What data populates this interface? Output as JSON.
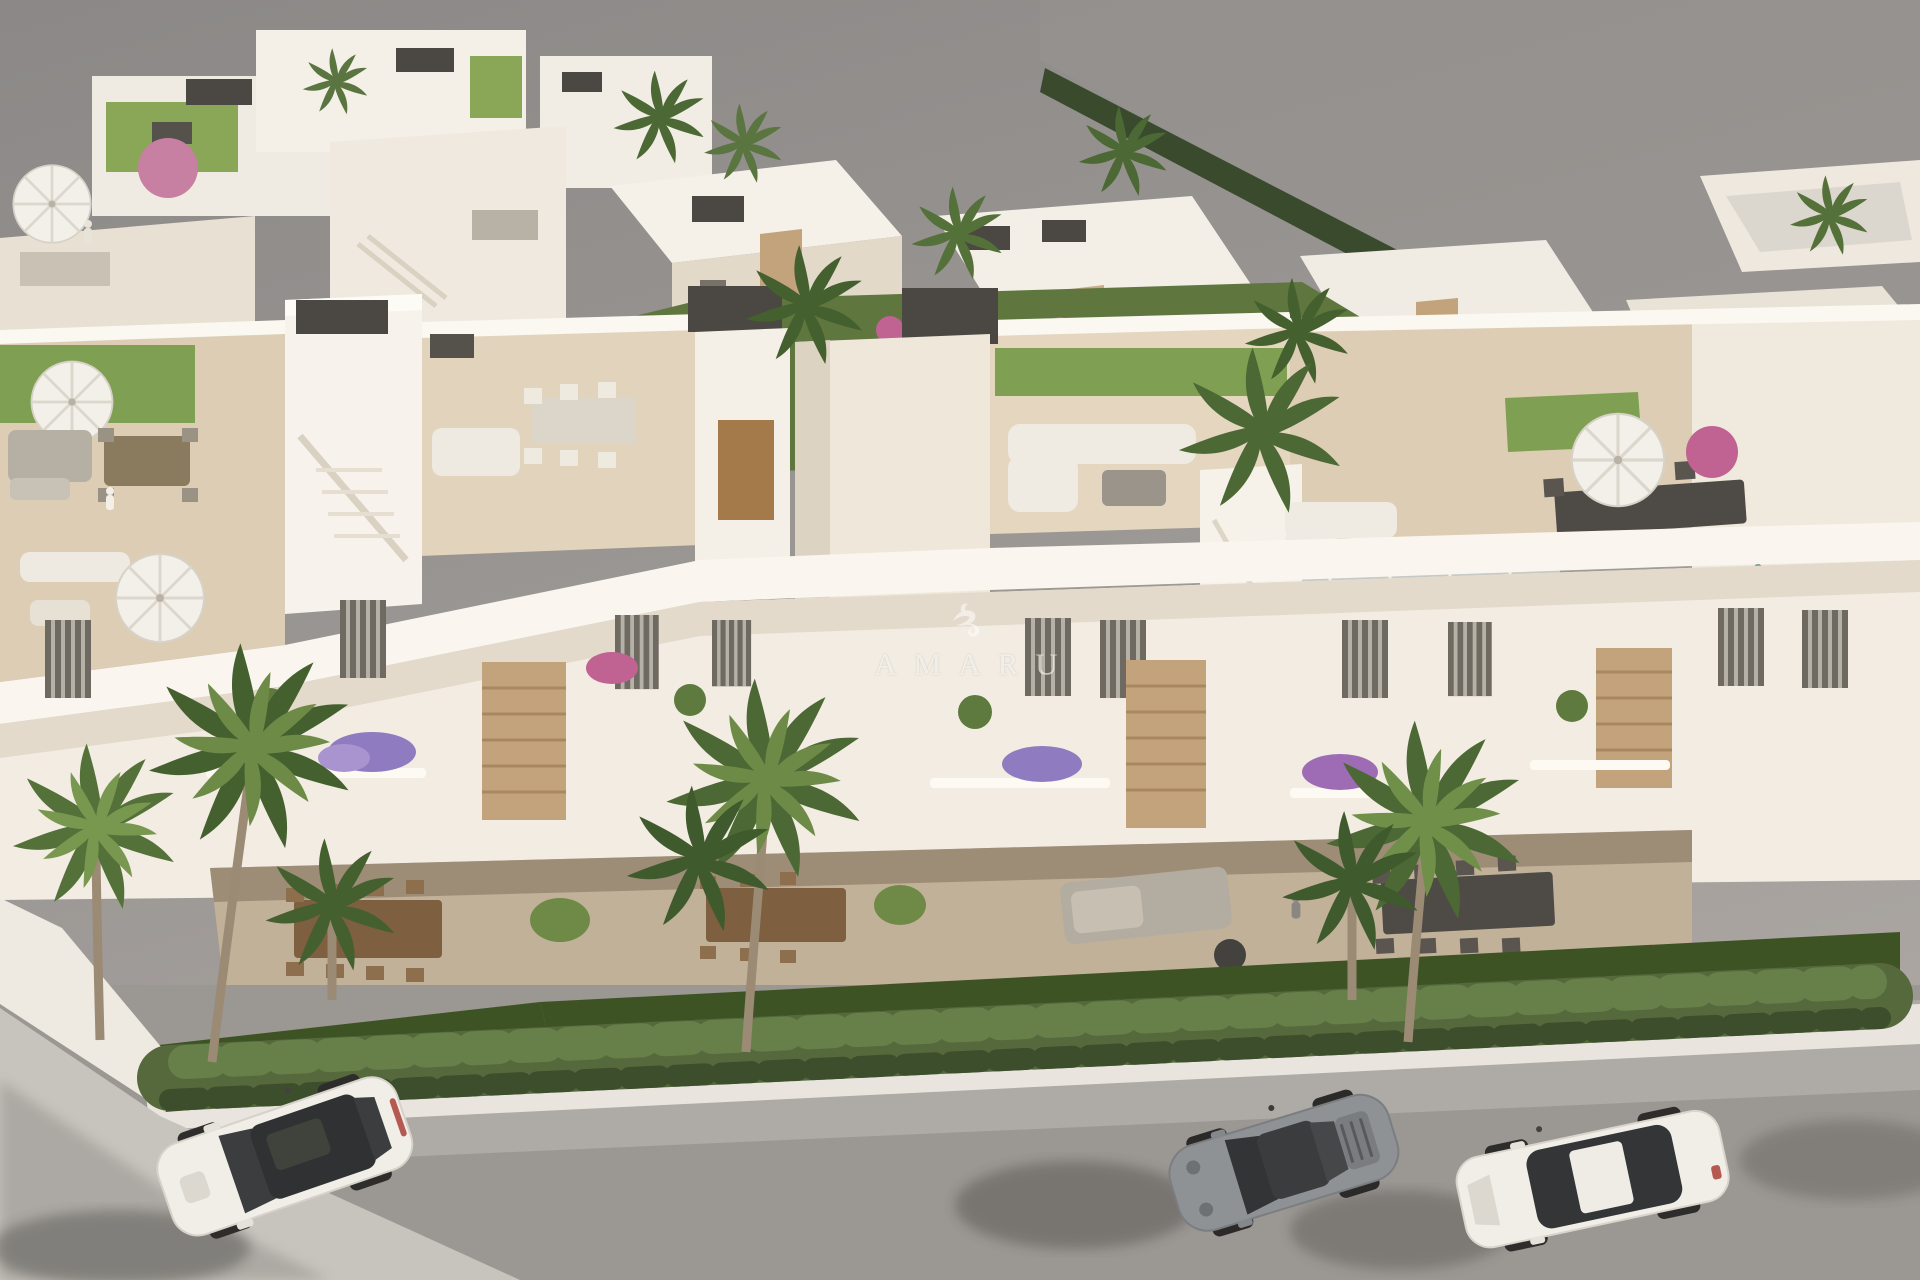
{
  "watermark": {
    "brand": "AMARU",
    "logo_icon": "hummingbird-logo-icon",
    "text_color": "#ffffff",
    "opacity": 0.62
  },
  "scene": {
    "setting": "aerial 3D architectural render of a white Mediterranean residential development with rooftop solarium terraces, balconies, gardens, palm trees, a cypress hedge and a street with three parked cars",
    "palette": {
      "sky": "#8d8a89",
      "ground": "#a6a29e",
      "road": "#9b9793",
      "road_shoulder": "#b2aea9",
      "sidewalk": "#c7c3bd",
      "curb": "#e9e5de",
      "wall_sunlit": "#f5f0e8",
      "wall_bright": "#fbf8f1",
      "wall_shaded": "#ded5c6",
      "terrace_floor": "#ddcdb4",
      "terrace_shade": "#c2b199",
      "roof_turf": "#7fa052",
      "lawn": "#3e5324",
      "hedge": "#55693c",
      "hedge_light": "#67804a",
      "hedge_dark": "#44573200",
      "palm_dark": "#45602f",
      "palm_light": "#6d8a47",
      "trunk": "#9b8a74",
      "stone": "#c2a37c",
      "wood": "#a57a4b",
      "dark_fixture": "#4b4742",
      "flower_pink": "#c06292",
      "flower_purple": "#8f7cc0",
      "umbrella": "#f3f0e9",
      "car_white": "#f1eee8",
      "car_gray": "#8f9295",
      "glass_dark": "#333537",
      "taillight_red": "#a93f37"
    },
    "street": {
      "cars": [
        {
          "id": "white-suv",
          "body": "#f1eee8",
          "roof_glass": "#2f3133"
        },
        {
          "id": "gray-sports-coupe",
          "body": "#8f9295",
          "roof_glass": "#3a3c3e"
        },
        {
          "id": "white-sedan",
          "body": "#f1eee8",
          "roof_glass": "#333537"
        }
      ]
    }
  }
}
